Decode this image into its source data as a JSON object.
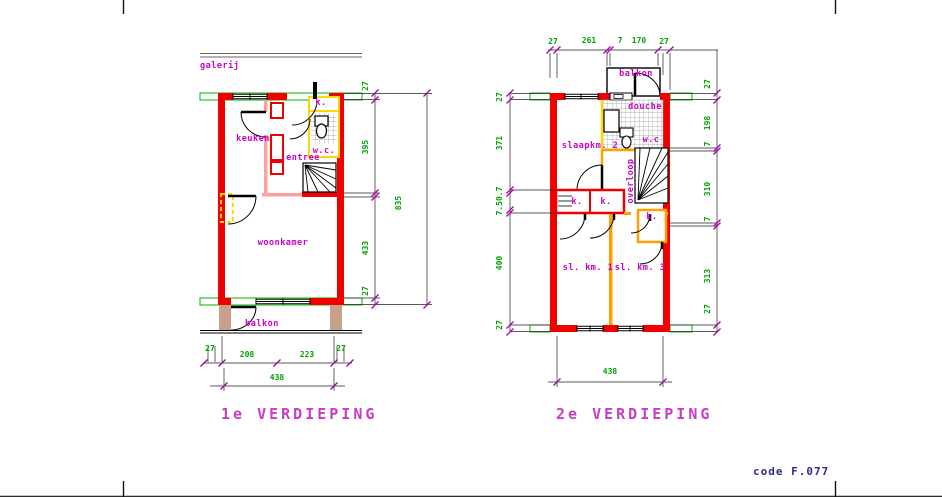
{
  "sheet": {
    "code_label": "code F.077"
  },
  "plan1": {
    "title": "1e VERDIEPING",
    "rooms": {
      "galerij": "galerij",
      "keuken": "keuken",
      "entree": "entree",
      "woonkamer": "woonkamer",
      "balkon": "balkon",
      "kast": "k.",
      "wc": "w.c."
    },
    "dims": {
      "right": [
        "27",
        "395",
        "433",
        "27"
      ],
      "right_total": "835",
      "bottom": [
        "27",
        "208",
        "223",
        "27"
      ],
      "bottom_total": "438"
    }
  },
  "plan2": {
    "title": "2e VERDIEPING",
    "rooms": {
      "balkon": "balkon",
      "douche": "douche",
      "wc": "w.c",
      "overloop": "overloop",
      "slaapkamer2": "slaapkm. 2",
      "kast1": "k.",
      "kast2": "k.",
      "kast3": "k.",
      "slaapkamer1": "sl. km. 1",
      "slaapkamer3": "sl. km. 3"
    },
    "dims": {
      "top": [
        "27",
        "261",
        "7",
        "170",
        "27"
      ],
      "left": [
        "27",
        "371",
        "7.50.7",
        "400",
        "27"
      ],
      "right": [
        "27",
        "198",
        "7",
        "310",
        "7",
        "313",
        "27"
      ],
      "bottom_total": "438"
    }
  },
  "colors": {
    "wall_red": "#f20000",
    "partition_pink": "#ff9f9f",
    "partition_orange": "#ffa000",
    "partition_yellow": "#ffd800",
    "sill_green": "#00b400",
    "dim_green": "#00a400",
    "label_magenta": "#cc00cc",
    "balcony_tan": "#c9a08b",
    "code_navy": "#2b2b8f"
  }
}
